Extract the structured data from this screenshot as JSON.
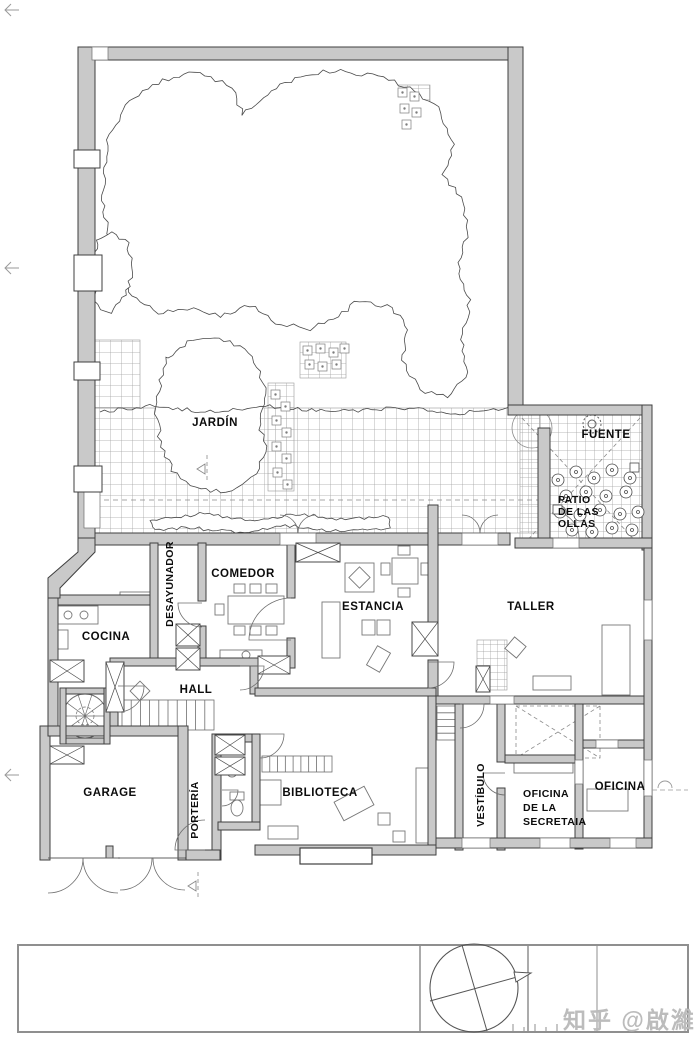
{
  "plan": {
    "rooms": {
      "jardin": "JARDÍN",
      "fuente": "FUENTE",
      "patio_lines": [
        "PATIO",
        "DE LAS",
        "OLLAS"
      ],
      "desayunador": "DESAYUNADOR",
      "comedor": "COMEDOR",
      "estancia": "ESTANCIA",
      "taller": "TALLER",
      "cocina": "COCINA",
      "hall": "HALL",
      "garage": "GARAGE",
      "porteria": "PORTERÍA",
      "biblioteca": "BIBLIOTECA",
      "vestibulo": "VESTÍBULO",
      "secretaria_lines": [
        "OFICINA",
        "DE LA",
        "SECRETAIA"
      ],
      "oficina": "OFICINA"
    },
    "colors": {
      "wall_fill": "#c9c9c9",
      "wall_stroke": "#3f3f3f",
      "thin_line": "#6e6e6e",
      "tile_line": "#a3a3a3",
      "watermark": "#bcbcbc"
    },
    "watermark": "知乎 @啟濰"
  }
}
